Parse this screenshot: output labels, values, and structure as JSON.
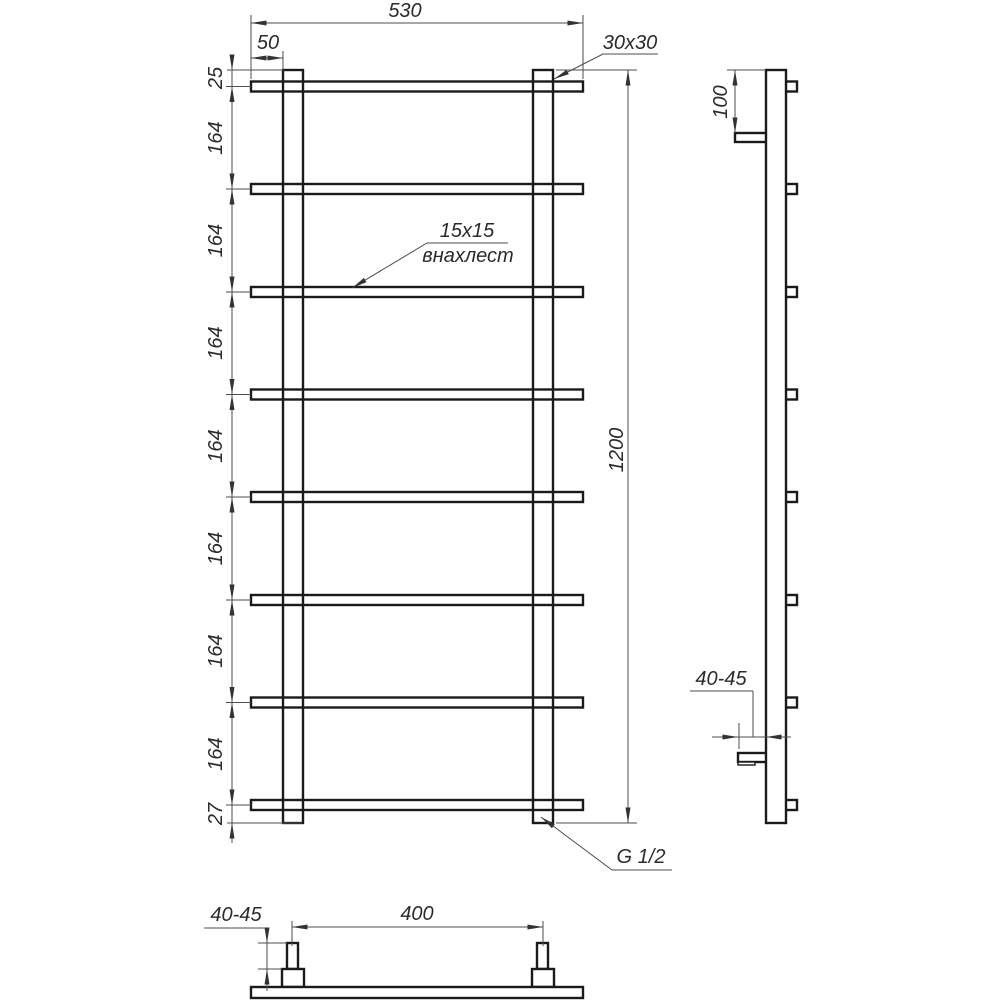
{
  "front_view": {
    "dim_width": "530",
    "dim_post_offset": "50",
    "dim_top_gap": "25",
    "dim_pitch": [
      "164",
      "164",
      "164",
      "164",
      "164",
      "164",
      "164"
    ],
    "dim_bottom_gap": "27",
    "dim_height": "1200",
    "label_post_tube": "30x30",
    "label_rung_tube": "15x15",
    "label_rung_mount": "внахлест",
    "label_thread": "G 1/2"
  },
  "side_view": {
    "dim_bracket_offset": "100",
    "dim_wall_clearance": "40-45"
  },
  "bottom_view": {
    "dim_connector_height": "40-45",
    "dim_connector_spacing": "400"
  },
  "colors": {
    "background": "#ffffff",
    "outline": "#1a1a1a",
    "dimension": "#4d4d4d"
  }
}
